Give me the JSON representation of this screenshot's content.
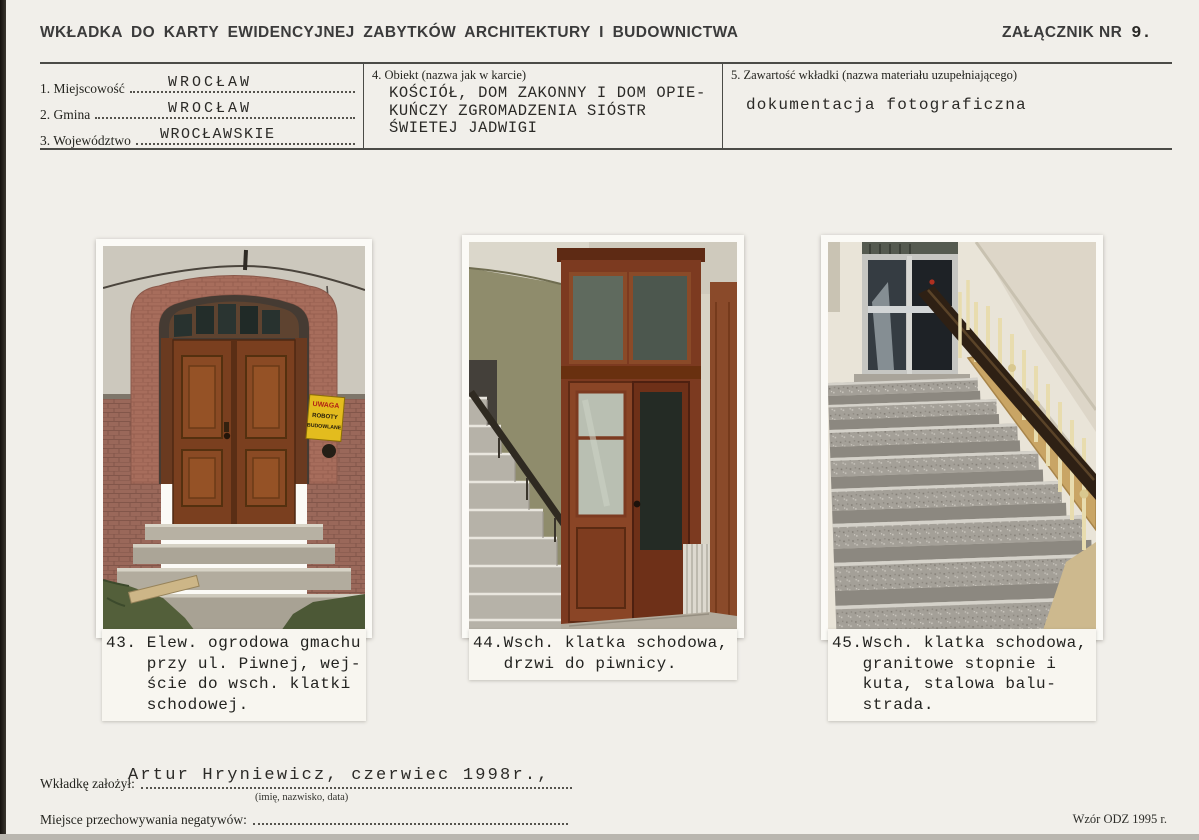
{
  "header": {
    "title": "WKŁADKA DO KARTY EWIDENCYJNEJ ZABYTKÓW ARCHITEKTURY I BUDOWNICTWA",
    "annex_label": "ZAŁĄCZNIK NR",
    "annex_number": "9."
  },
  "fields": {
    "f1_label": "1. Miejscowość",
    "f1_value": "WROCŁAW",
    "f2_label": "2. Gmina",
    "f2_value": "WROCŁAW",
    "f3_label": "3. Województwo",
    "f3_value": "WROCŁAWSKIE",
    "f4_label": "4. Obiekt (nazwa jak w karcie)",
    "f4_value": "KOŚCIÓŁ, DOM ZAKONNY I DOM OPIE-\nKUŃCZY ZGROMADZENIA SIÓSTR\nŚWIETEJ JADWIGI",
    "f5_label": "5. Zawartość wkładki (nazwa materiału uzupełniającego)",
    "f5_value": "dokumentacja fotograficzna"
  },
  "photos": [
    {
      "caption_lines": [
        "43. Elew. ogrodowa gmachu",
        "    przy ul. Piwnej, wej-",
        "    ście do wsch. klatki",
        "    schodowej."
      ],
      "sign_line1": "UWAGA",
      "sign_line2": "ROBOTY",
      "sign_line3": "BUDOWLANE"
    },
    {
      "caption_lines": [
        "44.Wsch. klatka schodowa,",
        "   drzwi do piwnicy."
      ]
    },
    {
      "caption_lines": [
        "45.Wsch. klatka schodowa,",
        "   granitowe stopnie i",
        "   kuta, stalowa balu-",
        "   strada."
      ]
    }
  ],
  "footer": {
    "founder_label": "Wkładkę założył:",
    "founder_value": "Artur Hryniewicz, czerwiec 1998r.,",
    "founder_sub": "(imię, nazwisko, data)",
    "negatives_label": "Miejsce przechowywania negatywów:",
    "form_code": "Wzór ODZ 1995 r."
  },
  "colors": {
    "page_bg": "#f1efea",
    "ink": "#2b2a27",
    "rule": "#4b4b47",
    "door_brown": "#7a3f1f",
    "portal_brick": "#a4695a",
    "lower_brick": "#9a685a",
    "sign_yellow": "#e3bc1e",
    "olive_wall": "#8f8c6c",
    "granite": "#a5a19a",
    "baluster_cream": "#e8dcae",
    "handrail_dark": "#2e2014"
  }
}
